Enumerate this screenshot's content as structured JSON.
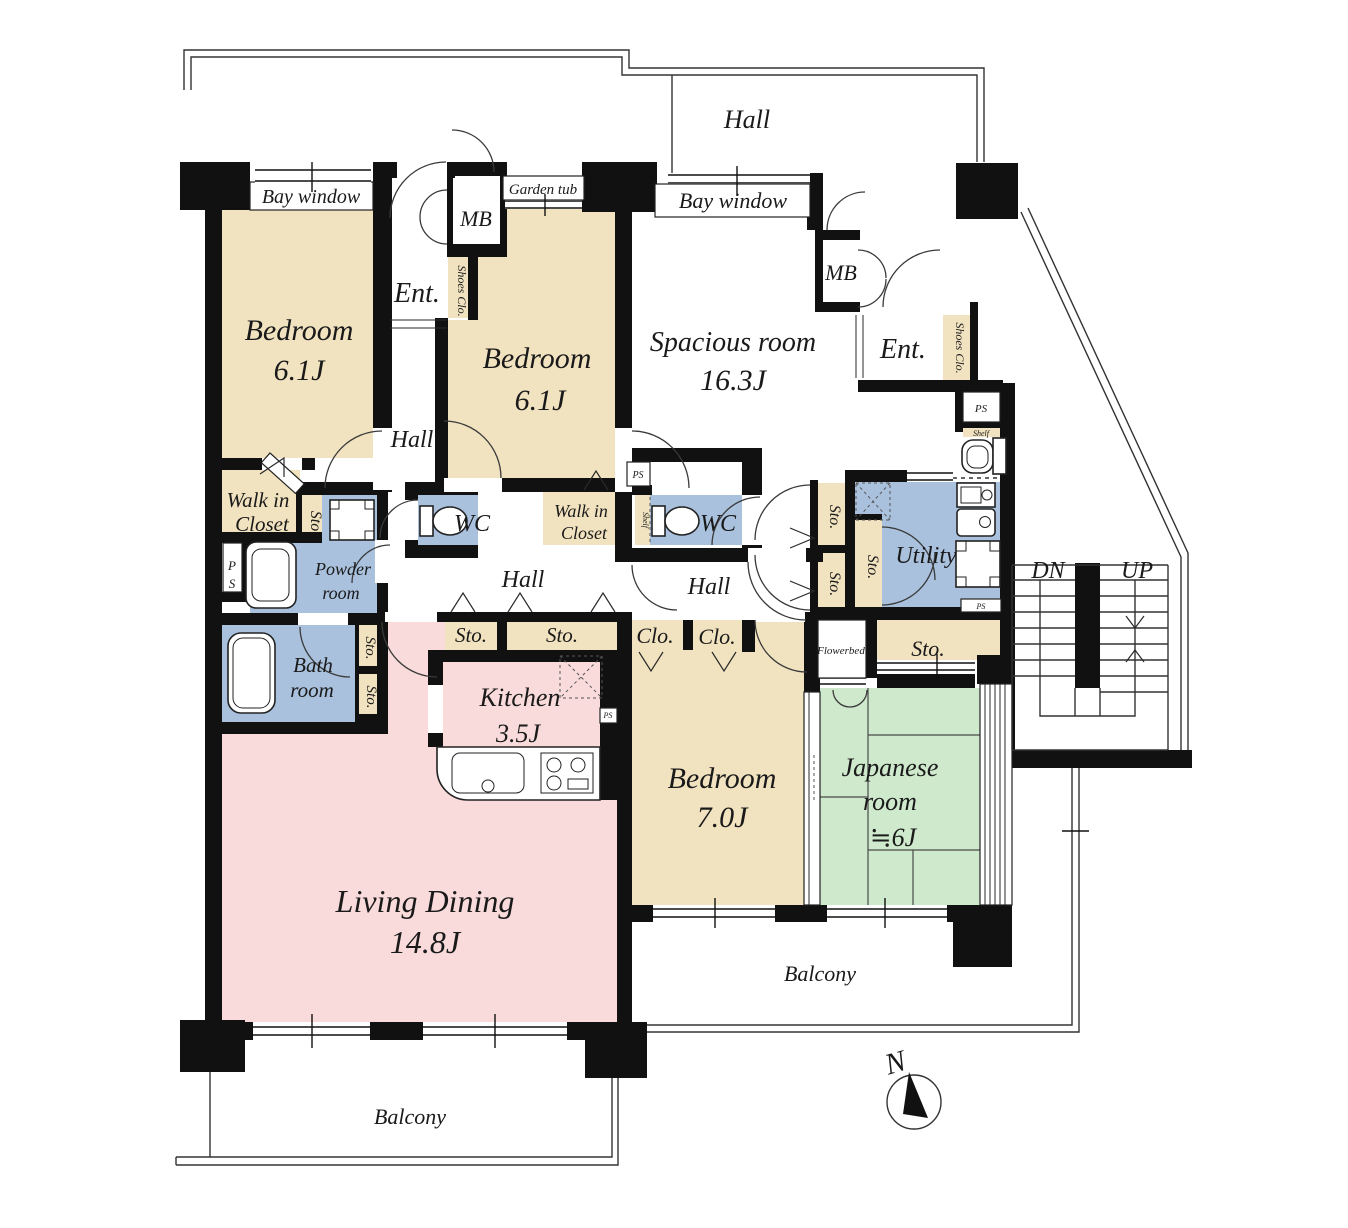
{
  "colors": {
    "beige": "#f2e3c0",
    "pink": "#f8dbda",
    "blue": "#a9c1dd",
    "green": "#cfe9cc",
    "wall": "#111111",
    "text": "#1a1a1a"
  },
  "labels": {
    "hall": "Hall",
    "bay_window": "Bay window",
    "garden_tub": "Garden tub",
    "mb": "MB",
    "ent": "Ent.",
    "shoes_clo": "Shoes Clo.",
    "walk_in": "Walk in",
    "closet": "Closet",
    "wc": "WC",
    "sto": "Sto.",
    "clo": "Clo.",
    "ps": "PS",
    "ps_p": "P",
    "ps_s": "S",
    "shelf": "Shelf",
    "flowerbed": "Flowerbed",
    "utility": "Utility",
    "balcony": "Balcony",
    "dn": "DN",
    "up": "UP",
    "north": "N"
  },
  "rooms": {
    "bedroom_a": {
      "name": "Bedroom",
      "size": "6.1J"
    },
    "bedroom_b": {
      "name": "Bedroom",
      "size": "6.1J"
    },
    "spacious": {
      "name": "Spacious room",
      "size": "16.3J"
    },
    "bedroom_c": {
      "name": "Bedroom",
      "size": "7.0J"
    },
    "japanese": {
      "line1": "Japanese",
      "line2": "room",
      "size": "≒6J"
    },
    "living": {
      "name": "Living Dining",
      "size": "14.8J"
    },
    "kitchen": {
      "name": "Kitchen",
      "size": "3.5J"
    },
    "powder": {
      "line1": "Powder",
      "line2": "room"
    },
    "bath": {
      "line1": "Bath",
      "line2": "room"
    }
  }
}
